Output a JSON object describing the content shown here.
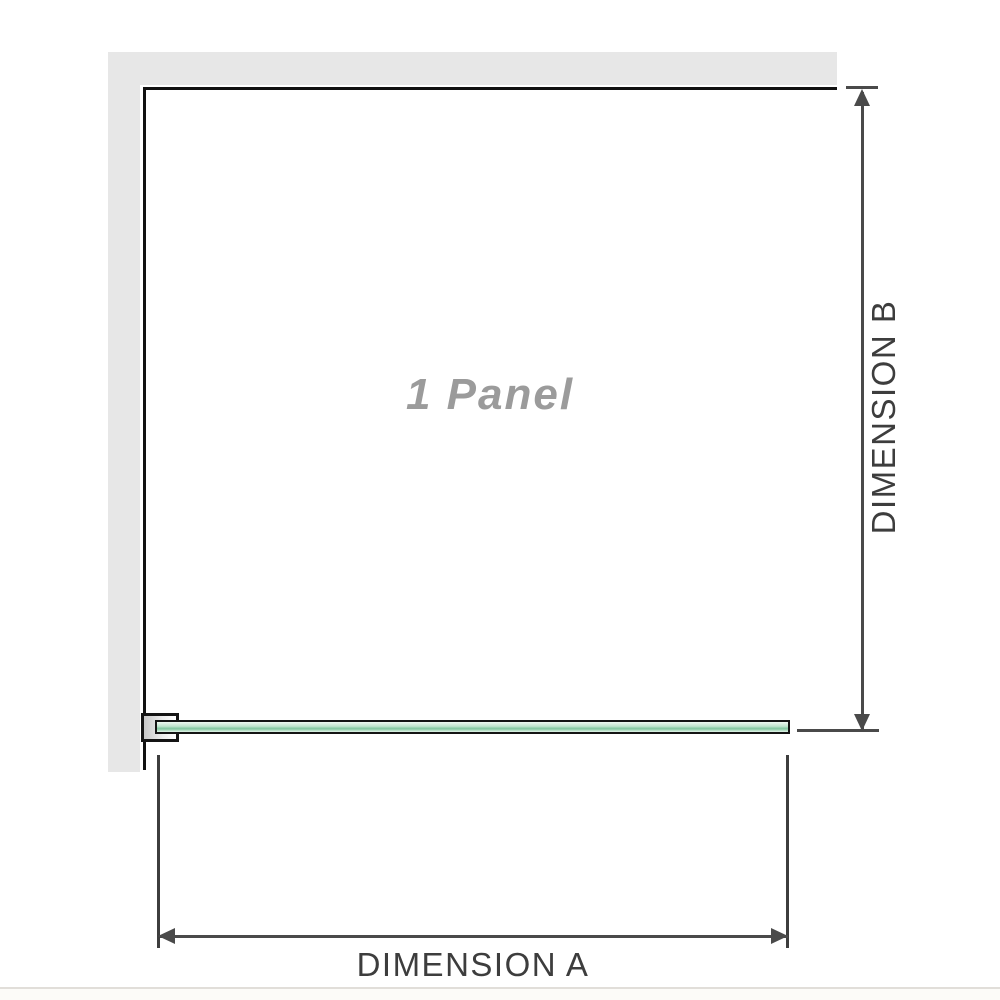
{
  "diagram": {
    "type": "shower-screen-dimension-diagram",
    "panel_label": "1 Panel",
    "dimension_a_label": "DIMENSION A",
    "dimension_b_label": "DIMENSION B",
    "colors": {
      "wall_gray": "#e7e7e7",
      "panel_outline_black": "#111111",
      "glass_green_light": "#d3ecdc",
      "glass_green_dark": "#84c7a1",
      "dimension_line_gray": "#4a4a4a",
      "panel_label_gray": "#9b9b9b",
      "dimension_text_gray": "#3d3d3d",
      "bottom_divider": "#e1ded9"
    }
  }
}
